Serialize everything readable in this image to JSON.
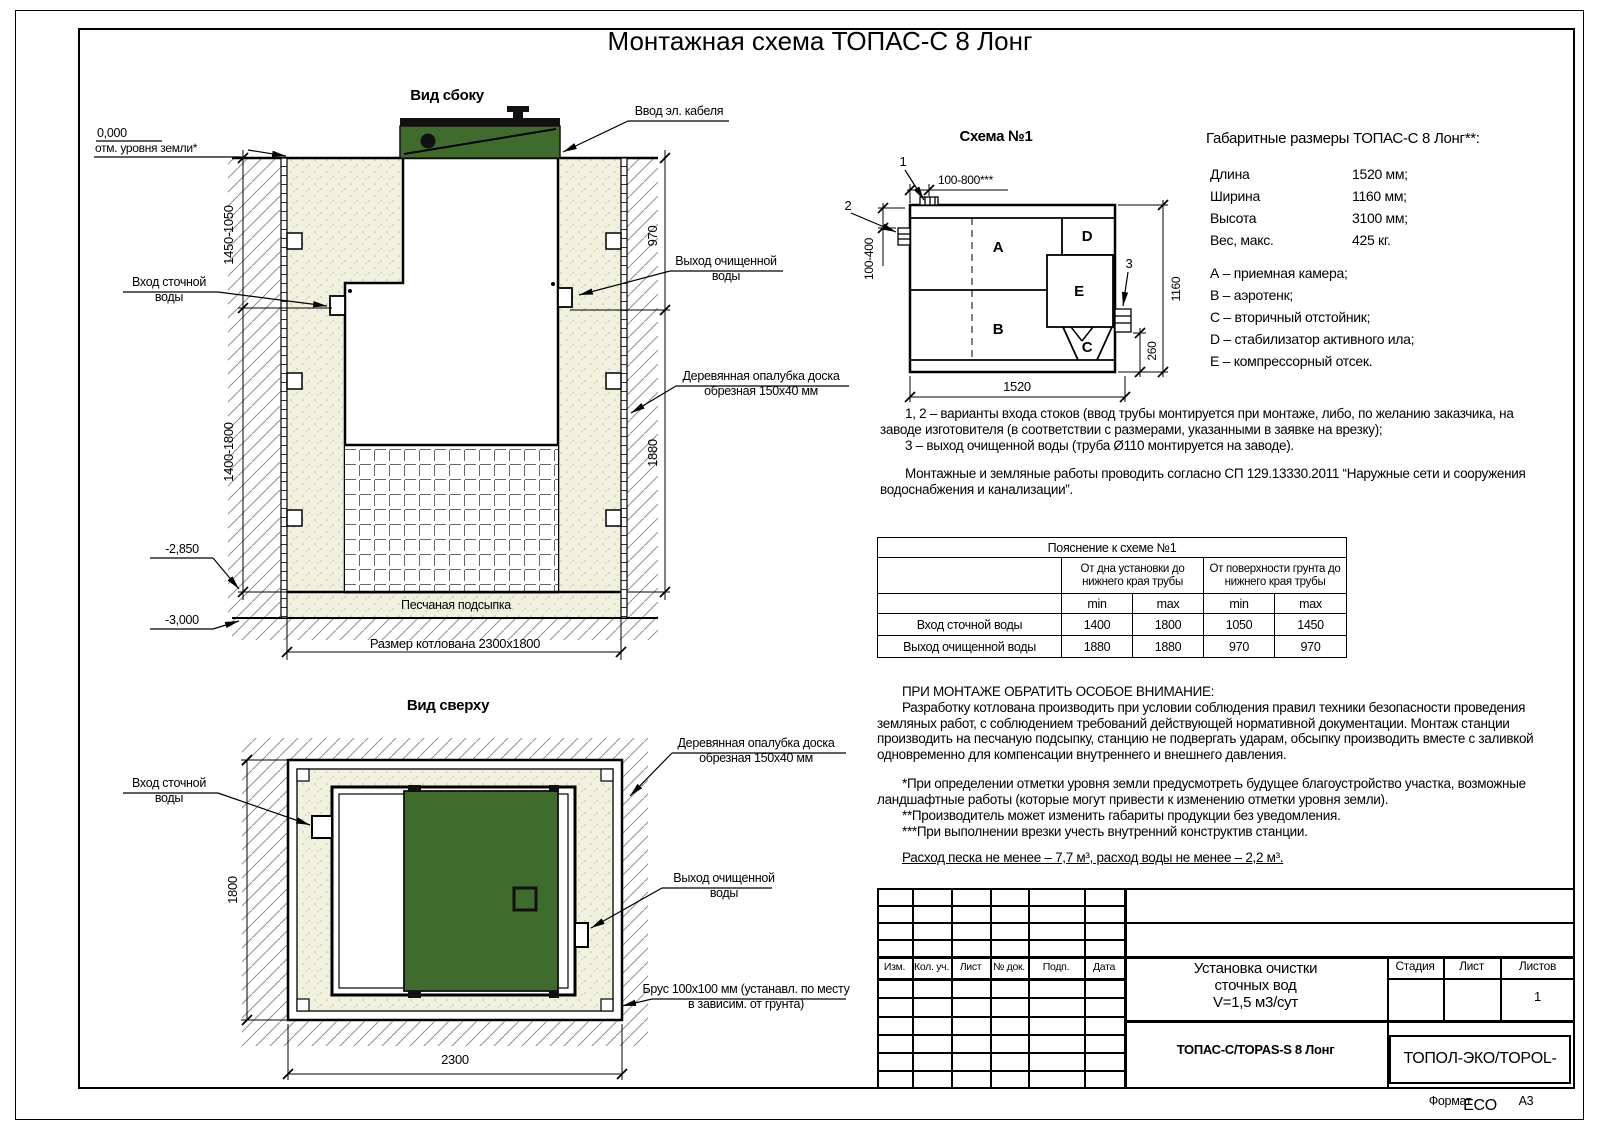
{
  "page": {
    "title": "Монтажная схема ТОПАС-С 8 Лонг",
    "format_label": "Формат",
    "format_value": "А3"
  },
  "labels": {
    "side_title": "Вид сбоку",
    "top_title": "Вид сверху",
    "schema_title": "Схема №1",
    "zero_mark": "0,000",
    "ground_mark": "отм. уровня земли*",
    "cable_entry": "Ввод эл. кабеля",
    "inlet": "Вход сточной воды",
    "outlet": "Выход очищенной воды",
    "formwork": "Деревянная опалубка доска обрезная 150х40 мм",
    "sand_bed": "Песчаная подсыпка",
    "pit_size": "Размер котлована 2300х1800",
    "beam": "Брус 100х100 мм (устанавл. по месту в зависим. от грунта)",
    "mark_2850": "-2,850",
    "mark_3000": "-3,000"
  },
  "dims": {
    "side_left_top": "1450-1050",
    "side_left_bottom": "1400-1800",
    "side_right_top": "970",
    "side_right_bottom": "1880",
    "top_height": "1800",
    "top_width": "2300",
    "schema_top": "100-800***",
    "schema_left": "100-400",
    "schema_width": "1160",
    "schema_outlet": "260",
    "schema_length": "1520"
  },
  "schema": {
    "callout_1": "1",
    "callout_2": "2",
    "callout_3": "3",
    "comp_a": "А",
    "comp_b": "В",
    "comp_c": "С",
    "comp_d": "D",
    "comp_e": "E"
  },
  "specs": {
    "title": "Габаритные размеры ТОПАС-С 8 Лонг**:",
    "rows": [
      {
        "name": "Длина",
        "value": "1520 мм;"
      },
      {
        "name": "Ширина",
        "value": "1160 мм;"
      },
      {
        "name": "Высота",
        "value": "3100 мм;"
      },
      {
        "name": "Вес, макс.",
        "value": "425 кг."
      }
    ],
    "legend": [
      "А – приемная камера;",
      "В – аэротенк;",
      "С – вторичный отстойник;",
      "D – стабилизатор активного ила;",
      "E – компрессорный отсек."
    ]
  },
  "notes": {
    "item12": "1, 2 – варианты входа стоков (ввод трубы монтируется при монтаже, либо, по желанию заказчика, на заводе изготовителя (в соответствии с размерами, указанными в заявке на врезку);",
    "item3": "3 – выход очищенной воды (труба Ø110 монтируется на заводе).",
    "works": "Монтажные и земляные работы проводить согласно СП 129.13330.2011 “Наружные сети и сооружения водоснабжения и канализации”."
  },
  "table": {
    "title": "Пояснение к схеме №1",
    "group1": "От дна установки до нижнего края трубы",
    "group2": "От поверхности грунта до нижнего края трубы",
    "sub": [
      "min",
      "max",
      "min",
      "max"
    ],
    "rows": [
      {
        "name": "Вход сточной воды",
        "values": [
          "1400",
          "1800",
          "1050",
          "1450"
        ]
      },
      {
        "name": "Выход очищенной воды",
        "values": [
          "1880",
          "1880",
          "970",
          "970"
        ]
      }
    ]
  },
  "attention": {
    "heading": "ПРИ МОНТАЖЕ ОБРАТИТЬ ОСОБОЕ ВНИМАНИЕ:",
    "para": "Разработку котлована производить при условии соблюдения правил техники безопасности проведения земляных работ, с соблюдением требований действующей нормативной документации. Монтаж станции производить на песчаную подсыпку, станцию не подвергать ударам, обсыпку производить вместе с заливкой одновременно для компенсации внутреннего и внешнего давления.",
    "fn1": "*При определении отметки уровня земли предусмотреть будущее благоустройство участка, возможные ландшафтные работы (которые могут привести к изменению отметки уровня земли).",
    "fn2": "**Производитель может изменить габариты продукции без уведомления.",
    "fn3": "***При выполнении врезки учесть внутренний конструктив станции.",
    "consumption": "Расход песка не менее – 7,7 м³, расход воды не менее – 2,2 м³."
  },
  "title_block": {
    "header_cells": [
      "Изм.",
      "Кол. уч.",
      "Лист",
      "№ док.",
      "Подп.",
      "Дата"
    ],
    "doc_title": [
      "Установка очистки",
      "сточных вод",
      "V=1,5 м3/сут"
    ],
    "stage_label": "Стадия",
    "sheet_label": "Лист",
    "sheets_label": "Листов",
    "sheets_value": "1",
    "product": "ТОПАС-С/TOPAS-S 8 Лонг",
    "company": "ТОПОЛ-ЭКО/TOPOL-ECO"
  },
  "colors": {
    "lid_green": "#3F6C2D",
    "sand": "#F1F1E0",
    "line": "#000000"
  }
}
